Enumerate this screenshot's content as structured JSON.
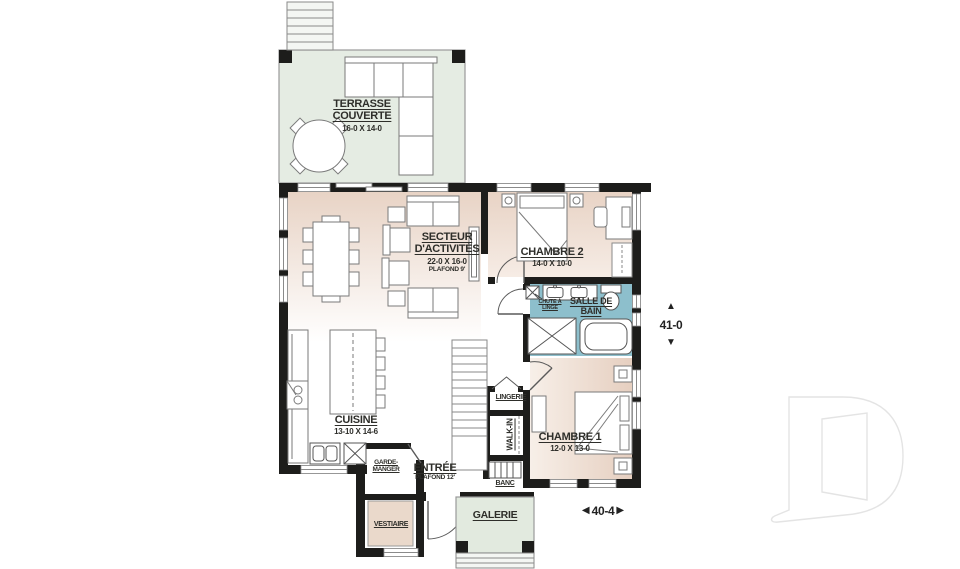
{
  "plan_type": "floor-plan",
  "rooms": {
    "terrasse": {
      "name": "TERRASSE COUVERTE",
      "dims": "16-0 X 14-0"
    },
    "secteur": {
      "name": "SECTEUR D'ACTIVITÉS",
      "dims": "22-0 X 16-0",
      "note": "PLAFOND 9'"
    },
    "chambre2": {
      "name": "CHAMBRE 2",
      "dims": "14-0 X 10-0"
    },
    "salle_de_bain": {
      "name": "SALLE DE BAIN"
    },
    "chute": {
      "name": "CHUTE À LINGE"
    },
    "chambre1": {
      "name": "CHAMBRE 1",
      "dims": "12-0 X 13-0"
    },
    "cuisine": {
      "name": "CUISINE",
      "dims": "13-10 X 14-6"
    },
    "entree": {
      "name": "ENTRÉE",
      "note": "PLAFOND 12'"
    },
    "garde_manger": {
      "name": "GARDE-MANGER"
    },
    "vestiaire": {
      "name": "VESTIAIRE"
    },
    "lingerie": {
      "name": "LINGERIE"
    },
    "walkin": {
      "name": "WALK-IN"
    },
    "banc": {
      "name": "BANC"
    },
    "galerie": {
      "name": "GALERIE"
    }
  },
  "dimensions": {
    "height": "41-0",
    "width": "40-4"
  },
  "arrows": {
    "up": "▲",
    "down": "▼",
    "left": "◀",
    "right": "▶"
  },
  "colors": {
    "wall": "#1d1d1b",
    "terrace_fill": "#e5ece3",
    "galerie_fill": "#e2eadf",
    "bathroom_fill": "#8dbfcc",
    "room_tan": "#e8d3c5",
    "closet_fill": "#ead9cb",
    "furniture_line": "#7a7a7a",
    "label_text": "#2e2e2a",
    "watermark": "#e4e4e4"
  }
}
